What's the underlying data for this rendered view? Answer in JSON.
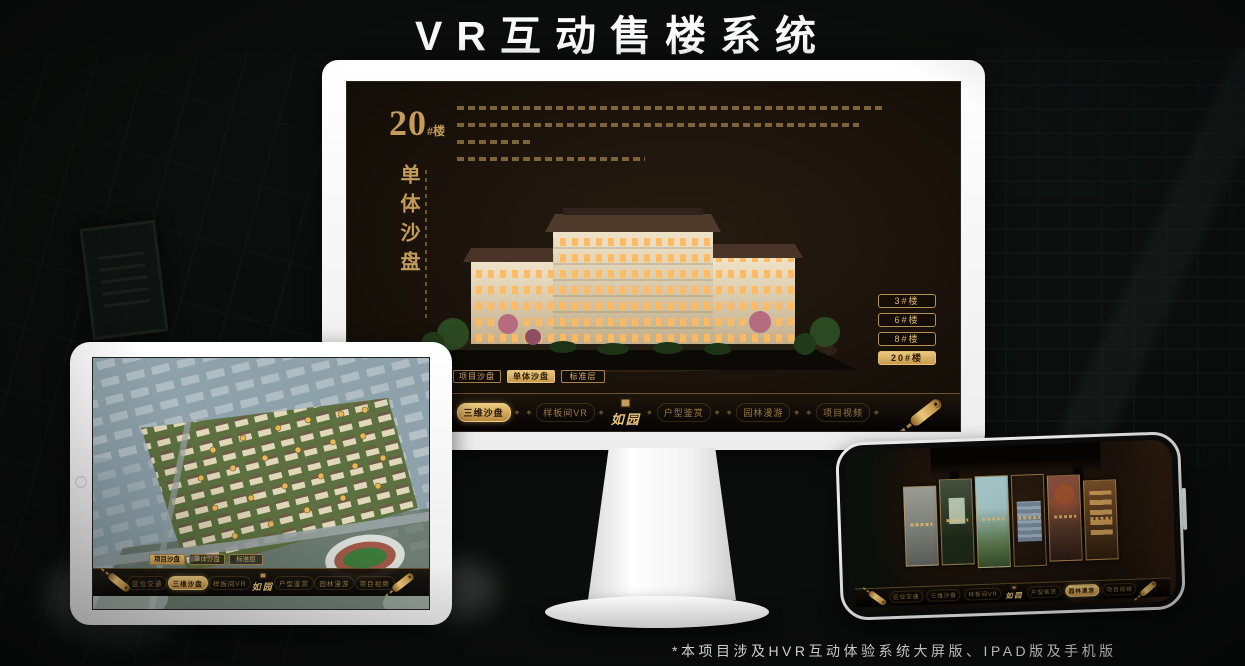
{
  "page": {
    "title": "VR互动售楼系统",
    "footnote": "*本项目涉及HVR互动体验系统大屏版、IPAD版及手机版"
  },
  "colors": {
    "gold": "#c59b5a",
    "gold_bright": "#e8c379",
    "gold_dim": "#9c7b44",
    "active_text": "#2b1c07",
    "screen_bg": "#171008",
    "title_color": "#fafafa"
  },
  "monitor": {
    "building_no": "20",
    "building_no_suffix": "#楼",
    "vertical_title": "单体沙盘",
    "floor_buttons": [
      {
        "label": "3#楼",
        "active": false
      },
      {
        "label": "6#楼",
        "active": false
      },
      {
        "label": "8#楼",
        "active": false
      },
      {
        "label": "20#楼",
        "active": true
      }
    ],
    "sub_tabs": [
      {
        "label": "项目沙盘",
        "active": false
      },
      {
        "label": "单体沙盘",
        "active": true
      },
      {
        "label": "标准层",
        "active": false
      }
    ],
    "nav": {
      "logo": "如园",
      "items": [
        {
          "label": "区位交通",
          "active": false
        },
        {
          "label": "三维沙盘",
          "active": true
        },
        {
          "label": "样板间VR",
          "active": false
        },
        {
          "label": "户型鉴赏",
          "active": false
        },
        {
          "label": "园林漫游",
          "active": false
        },
        {
          "label": "项目视频",
          "active": false
        }
      ]
    }
  },
  "tablet": {
    "sub_tabs": [
      {
        "label": "项目沙盘",
        "active": true
      },
      {
        "label": "单体沙盘",
        "active": false
      },
      {
        "label": "标准层",
        "active": false
      }
    ],
    "nav": {
      "logo": "如园",
      "items": [
        {
          "label": "区位交通",
          "active": false
        },
        {
          "label": "三维沙盘",
          "active": true
        },
        {
          "label": "样板间VR",
          "active": false
        },
        {
          "label": "户型鉴赏",
          "active": false
        },
        {
          "label": "园林漫游",
          "active": false
        },
        {
          "label": "项目视频",
          "active": false
        }
      ]
    }
  },
  "phone": {
    "nav": {
      "logo": "如园",
      "items": [
        {
          "label": "区位交通",
          "active": false
        },
        {
          "label": "三维沙盘",
          "active": false
        },
        {
          "label": "样板间VR",
          "active": false
        },
        {
          "label": "户型鉴赏",
          "active": false
        },
        {
          "label": "园林漫游",
          "active": true
        },
        {
          "label": "项目视频",
          "active": false
        }
      ]
    }
  }
}
